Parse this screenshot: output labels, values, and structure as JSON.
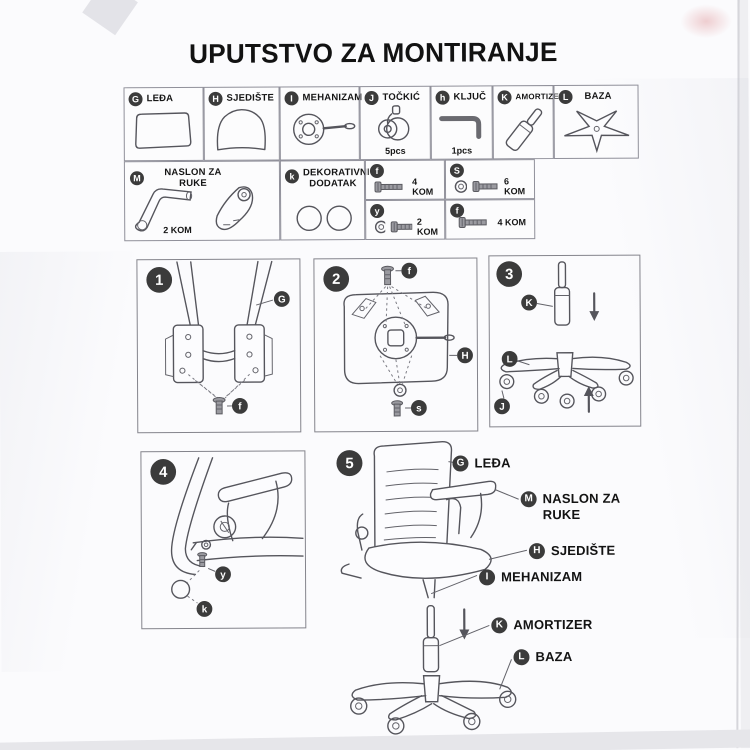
{
  "title": "UPUTSTVO ZA MONTIRANJE",
  "colors": {
    "ink": "#121212",
    "line": "#55555c",
    "badge_bg": "#3b3b3b",
    "table_border": "#90909a"
  },
  "parts_row1": [
    {
      "badge": "G",
      "label": "LEĐA"
    },
    {
      "badge": "H",
      "label": "SJEDIŠTE"
    },
    {
      "badge": "I",
      "label": "MEHANIZAM"
    },
    {
      "badge": "J",
      "label": "TOČKIĆ",
      "qty": "5pcs"
    },
    {
      "badge": "h",
      "label": "KLJUČ",
      "qty": "1pcs"
    },
    {
      "badge": "K",
      "label": "AMORTIZER"
    },
    {
      "badge": "L",
      "label": "BAZA"
    }
  ],
  "parts_row2": {
    "armrest": {
      "badge": "M",
      "label": "NASLON ZA RUKE",
      "qty": "2 KOM"
    },
    "decor": {
      "badge": "k",
      "label": "DEKORATIVNI DODATAK"
    }
  },
  "screws": [
    {
      "badge": "f",
      "qty": "4 KOM"
    },
    {
      "badge": "S",
      "qty": "6 KOM"
    },
    {
      "badge": "y",
      "qty": "2 KOM"
    },
    {
      "badge": "f",
      "qty": "4 KOM"
    }
  ],
  "steps": [
    {
      "num": "1",
      "callouts": [
        "G",
        "f"
      ]
    },
    {
      "num": "2",
      "callouts": [
        "f",
        "H",
        "s"
      ]
    },
    {
      "num": "3",
      "callouts": [
        "K",
        "L",
        "J"
      ]
    },
    {
      "num": "4",
      "callouts": [
        "y",
        "k"
      ]
    },
    {
      "num": "5",
      "labels": [
        {
          "badge": "G",
          "label": "LEĐA"
        },
        {
          "badge": "M",
          "label": "NASLON ZA RUKE"
        },
        {
          "badge": "H",
          "label": "SJEDIŠTE"
        },
        {
          "badge": "I",
          "label": "MEHANIZAM"
        },
        {
          "badge": "K",
          "label": "AMORTIZER"
        },
        {
          "badge": "L",
          "label": "BAZA"
        }
      ]
    }
  ]
}
